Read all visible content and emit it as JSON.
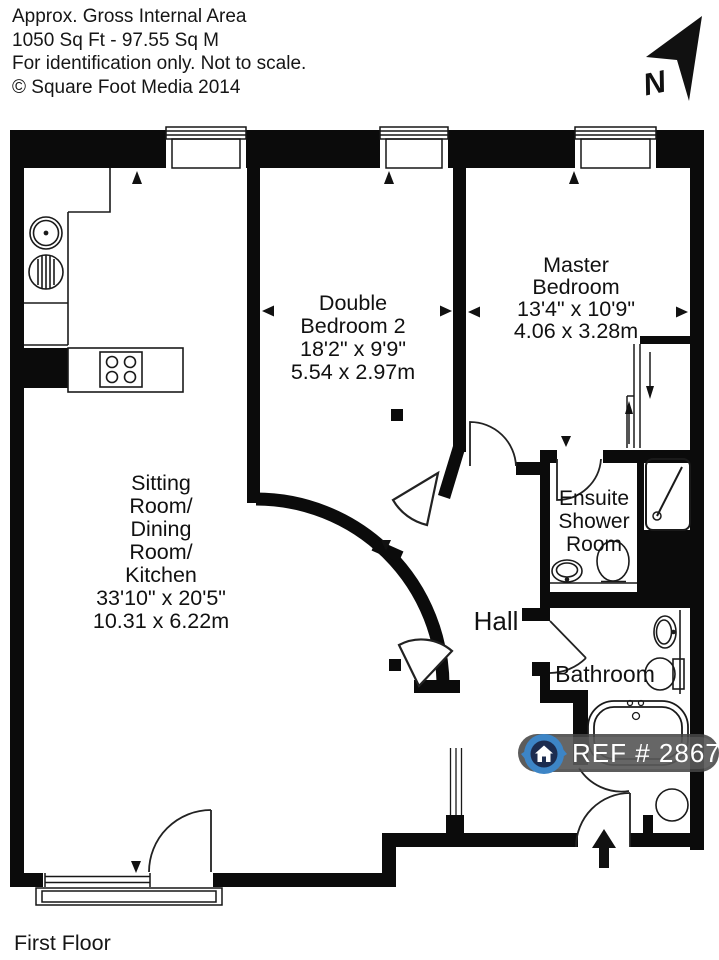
{
  "header": {
    "line1": "Approx. Gross Internal Area",
    "line2": "1050 Sq Ft  -  97.55 Sq M",
    "line3": "For identification only. Not to scale.",
    "line4": "© Square Foot Media 2014"
  },
  "compass": {
    "label": "N"
  },
  "rooms": {
    "sitting": {
      "lines": [
        "Sitting",
        "Room/",
        "Dining",
        "Room/",
        "Kitchen"
      ],
      "imperial": "33'10\" x 20'5\"",
      "metric": "10.31 x 6.22m"
    },
    "bedroom2": {
      "lines": [
        "Double",
        "Bedroom 2"
      ],
      "imperial": "18'2\" x 9'9\"",
      "metric": "5.54 x 2.97m"
    },
    "master": {
      "lines": [
        "Master",
        "Bedroom"
      ],
      "imperial": "13'4\" x 10'9\"",
      "metric": "4.06 x 3.28m"
    },
    "ensuite": {
      "lines": [
        "Ensuite",
        "Shower",
        "Room"
      ]
    },
    "hall": {
      "label": "Hall"
    },
    "bathroom": {
      "label": "Bathroom"
    }
  },
  "badge": {
    "ref": "REF # 2867344",
    "accent": "#3d85c6"
  },
  "footer": {
    "floor": "First Floor"
  }
}
